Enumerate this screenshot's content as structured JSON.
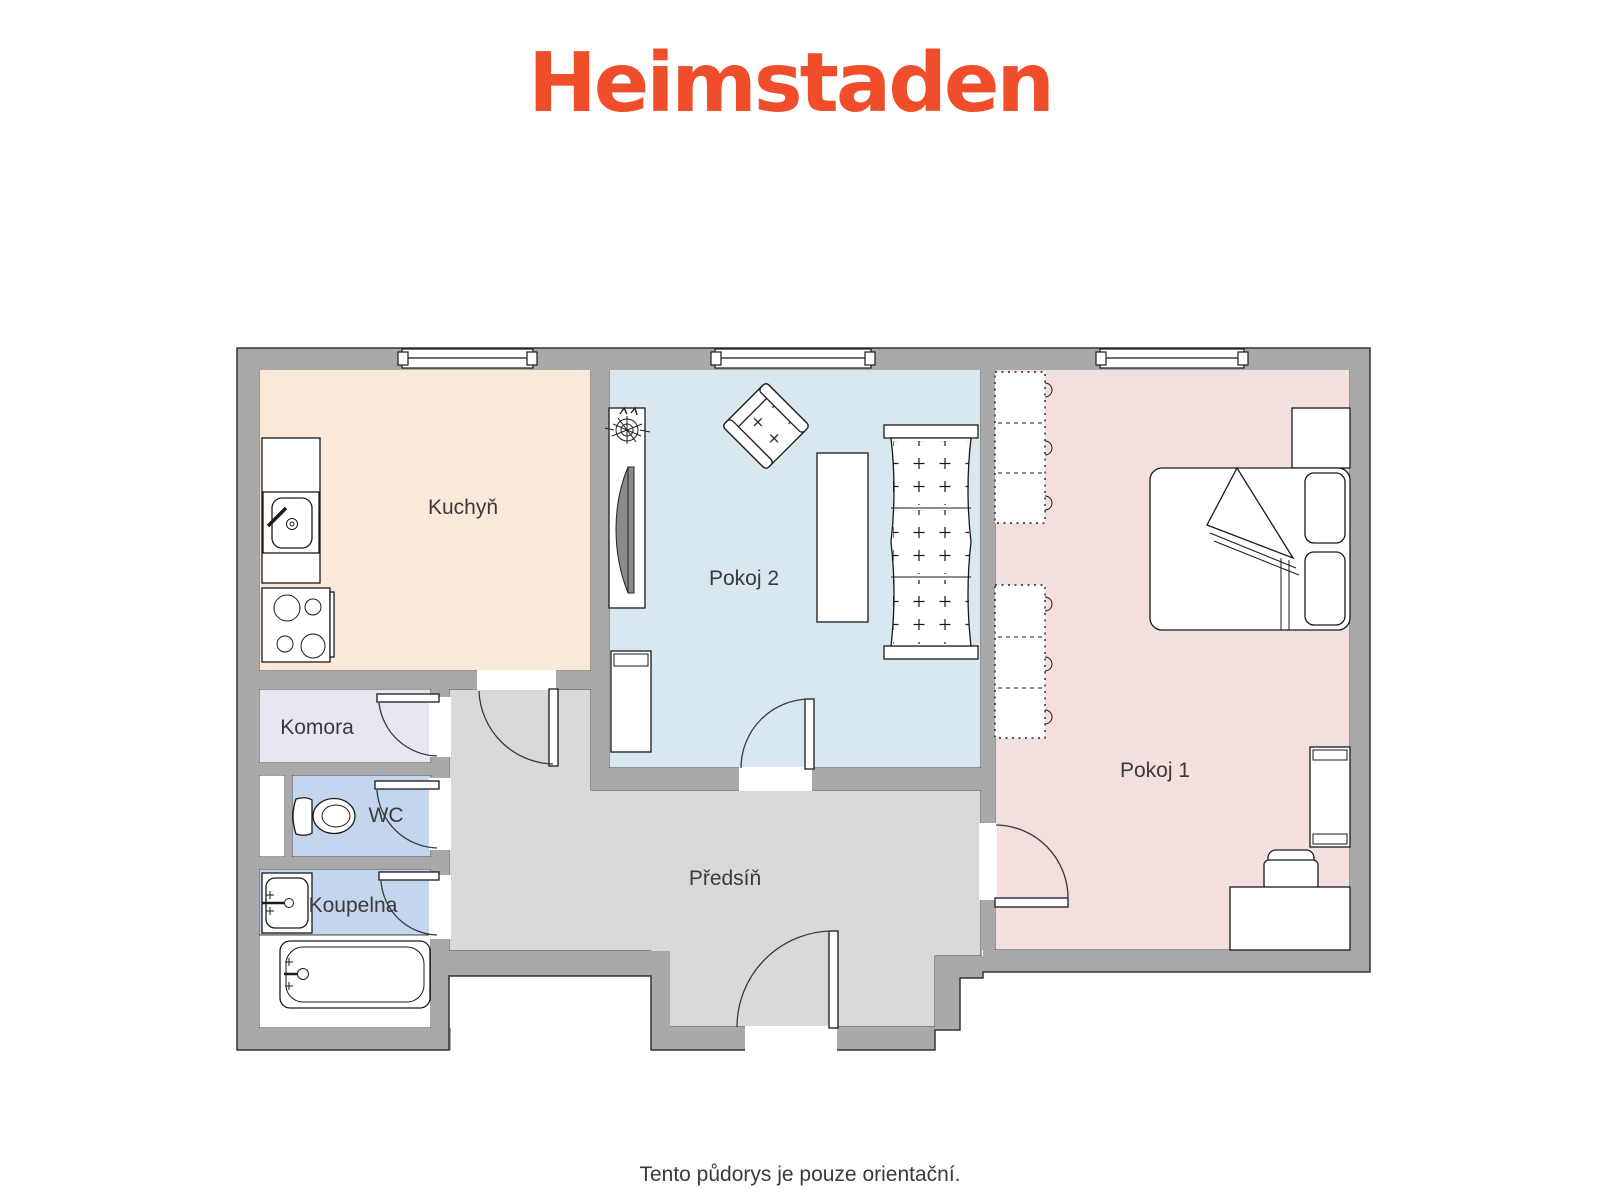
{
  "header": {
    "logo_text": "Heimstaden"
  },
  "palette": {
    "logo_orange": "#F04E2A",
    "wall_gray": "#A9A9A9",
    "outline": "#333333",
    "label_color": "#3A3A3A"
  },
  "rooms": {
    "kuchyn": {
      "label": "Kuchyň",
      "color": "#FAE8D9"
    },
    "pokoj2": {
      "label": "Pokoj 2",
      "color": "#D9E8F0"
    },
    "pokoj1": {
      "label": "Pokoj 1",
      "color": "#F2DFDE"
    },
    "komora": {
      "label": "Komora",
      "color": "#E8E7F1"
    },
    "wc": {
      "label": "WC",
      "color": "#C3D6EE"
    },
    "koupelna": {
      "label": "Koupelna",
      "color": "#C3D6EE"
    },
    "predsin": {
      "label": "Předsíň",
      "color": "#D9D9D9"
    }
  },
  "fixtures": [
    "kitchen-sink-icon",
    "stove-icon",
    "toilet-icon",
    "washbasin-icon",
    "bathtub-icon",
    "plant-icon",
    "tv-icon",
    "armchair-icon",
    "sofa-icon",
    "table-icon",
    "cabinet-icon",
    "wardrobe-icon",
    "bed-icon",
    "nightstand-icon",
    "shelf-icon",
    "desk-icon",
    "chair-icon",
    "window-icon",
    "door-icon"
  ],
  "footer": {
    "note": "Tento půdorys je pouze orientační."
  }
}
